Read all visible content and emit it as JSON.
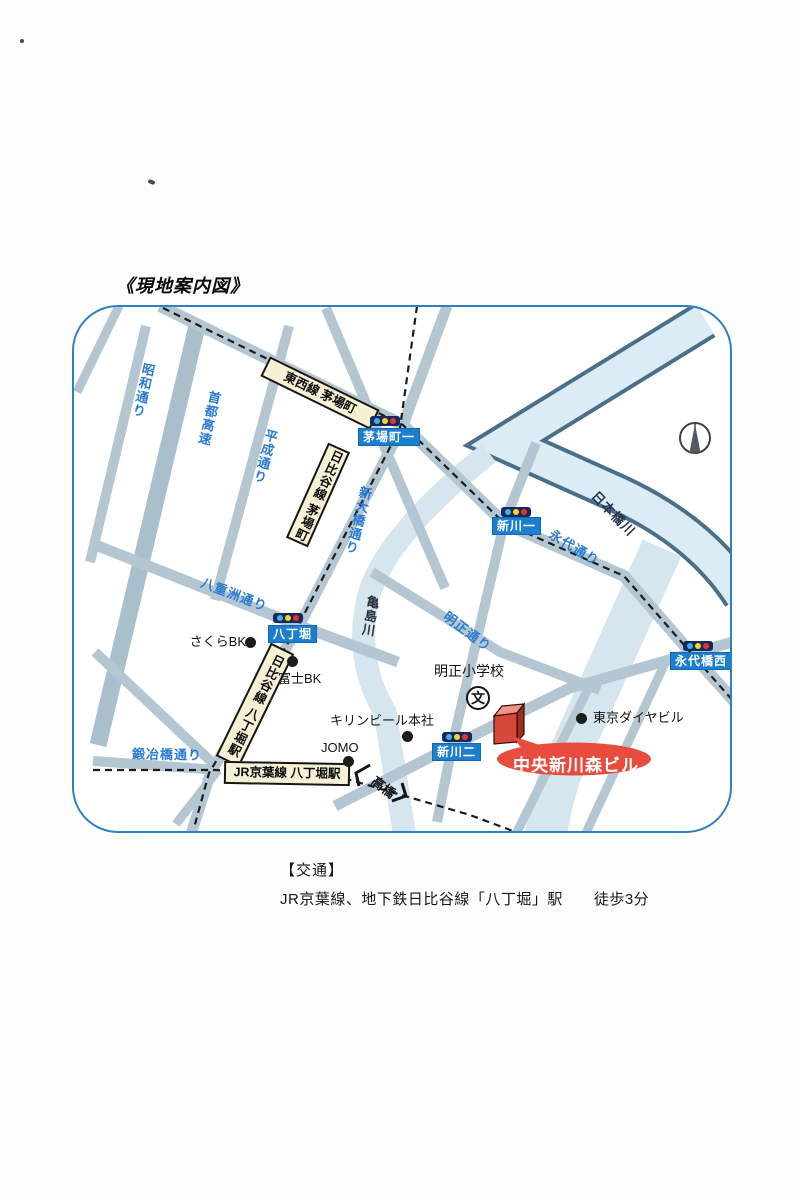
{
  "page_title": "《現地案内図》",
  "map": {
    "road_labels": [
      {
        "id": "showa-dori",
        "text": "昭和通り"
      },
      {
        "id": "shuto-expressway",
        "text": "首都高速"
      },
      {
        "id": "heisei-dori",
        "text": "平成通り"
      },
      {
        "id": "shin-ohashi-dori",
        "text": "新大橋通り"
      },
      {
        "id": "eitai-dori",
        "text": "永代通り"
      },
      {
        "id": "yaesu-dori",
        "text": "八重洲通り"
      },
      {
        "id": "meisho-dori",
        "text": "明正通り"
      },
      {
        "id": "kajibashi-dori",
        "text": "鍛冶橋通り"
      }
    ],
    "rivers": [
      {
        "id": "nihonbashi-river",
        "text": "日本橋川"
      },
      {
        "id": "kameshima-river",
        "text": "亀島川"
      }
    ],
    "stations": [
      {
        "id": "tozai-kayabacho",
        "text": "東西線 茅場町"
      },
      {
        "id": "hibiya-kayabacho",
        "text": "日比谷線 茅場町"
      },
      {
        "id": "hibiya-hatchobori",
        "text": "日比谷線 八丁堀駅"
      },
      {
        "id": "jr-keiyo-hatchobori",
        "text": "JR京葉線 八丁堀駅"
      }
    ],
    "crossings": [
      {
        "id": "kayabacho-1",
        "text": "茅場町一"
      },
      {
        "id": "shinkawa-1",
        "text": "新川一"
      },
      {
        "id": "hatchobori",
        "text": "八丁堀"
      },
      {
        "id": "shinkawa-2",
        "text": "新川二"
      },
      {
        "id": "eitaibashi-west",
        "text": "永代橋西"
      }
    ],
    "pois": [
      {
        "id": "sakura-bk",
        "text": "さくらBK"
      },
      {
        "id": "fuji-bk",
        "text": "富士BK"
      },
      {
        "id": "kirin-beer-hq",
        "text": "キリンビール本社"
      },
      {
        "id": "jomo",
        "text": "JOMO"
      },
      {
        "id": "tokyo-daiya-bldg",
        "text": "東京ダイヤビル"
      }
    ],
    "school": {
      "name": "明正小学校",
      "symbol": "文"
    },
    "bridge": {
      "text": "高橋"
    },
    "destination": {
      "text": "中央新川森ビル"
    }
  },
  "footer": {
    "heading": "【交通】",
    "access": "JR京葉線、地下鉄日比谷線「八丁堀」駅　　徒歩3分"
  },
  "colors": {
    "map_border": "#2f7fc1",
    "road": "#b4c6d2",
    "river": "#d5e6ef",
    "river_edge": "#4a7089",
    "station_box": "#f6f0d5",
    "crossing_box": "#1b7fd0",
    "road_label_blue": "#2b7cd1",
    "destination_red": "#e74c3f",
    "building_red": "#d6483b"
  }
}
